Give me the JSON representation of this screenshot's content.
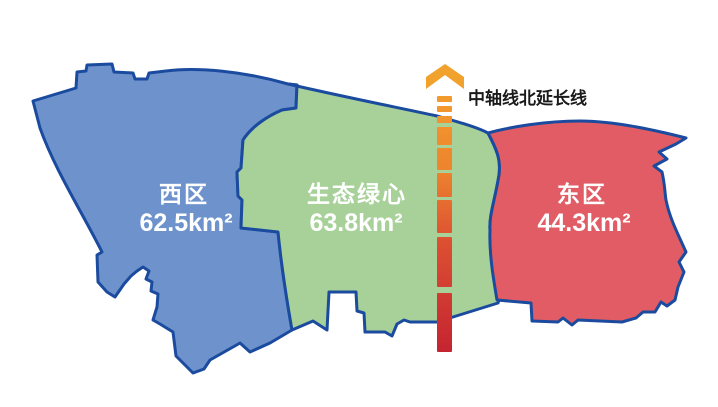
{
  "map": {
    "axis_label": "中轴线北延长线",
    "regions": [
      {
        "name": "西区",
        "area": "62.5km²",
        "color": "#6E93CC"
      },
      {
        "name": "生态绿心",
        "area": "63.8km²",
        "color": "#A8D19A"
      },
      {
        "name": "东区",
        "area": "44.3km²",
        "color": "#E15C64"
      }
    ],
    "colors": {
      "border": "#1B4B9E",
      "label_text": "#FFFFFF",
      "axis_label_text": "#1A1A1A",
      "axis_arrow": "#F0A22C",
      "axis_stops": [
        "#F5A72D",
        "#ED832E",
        "#DC5032",
        "#C52431"
      ],
      "background": "#FFFFFF"
    }
  }
}
